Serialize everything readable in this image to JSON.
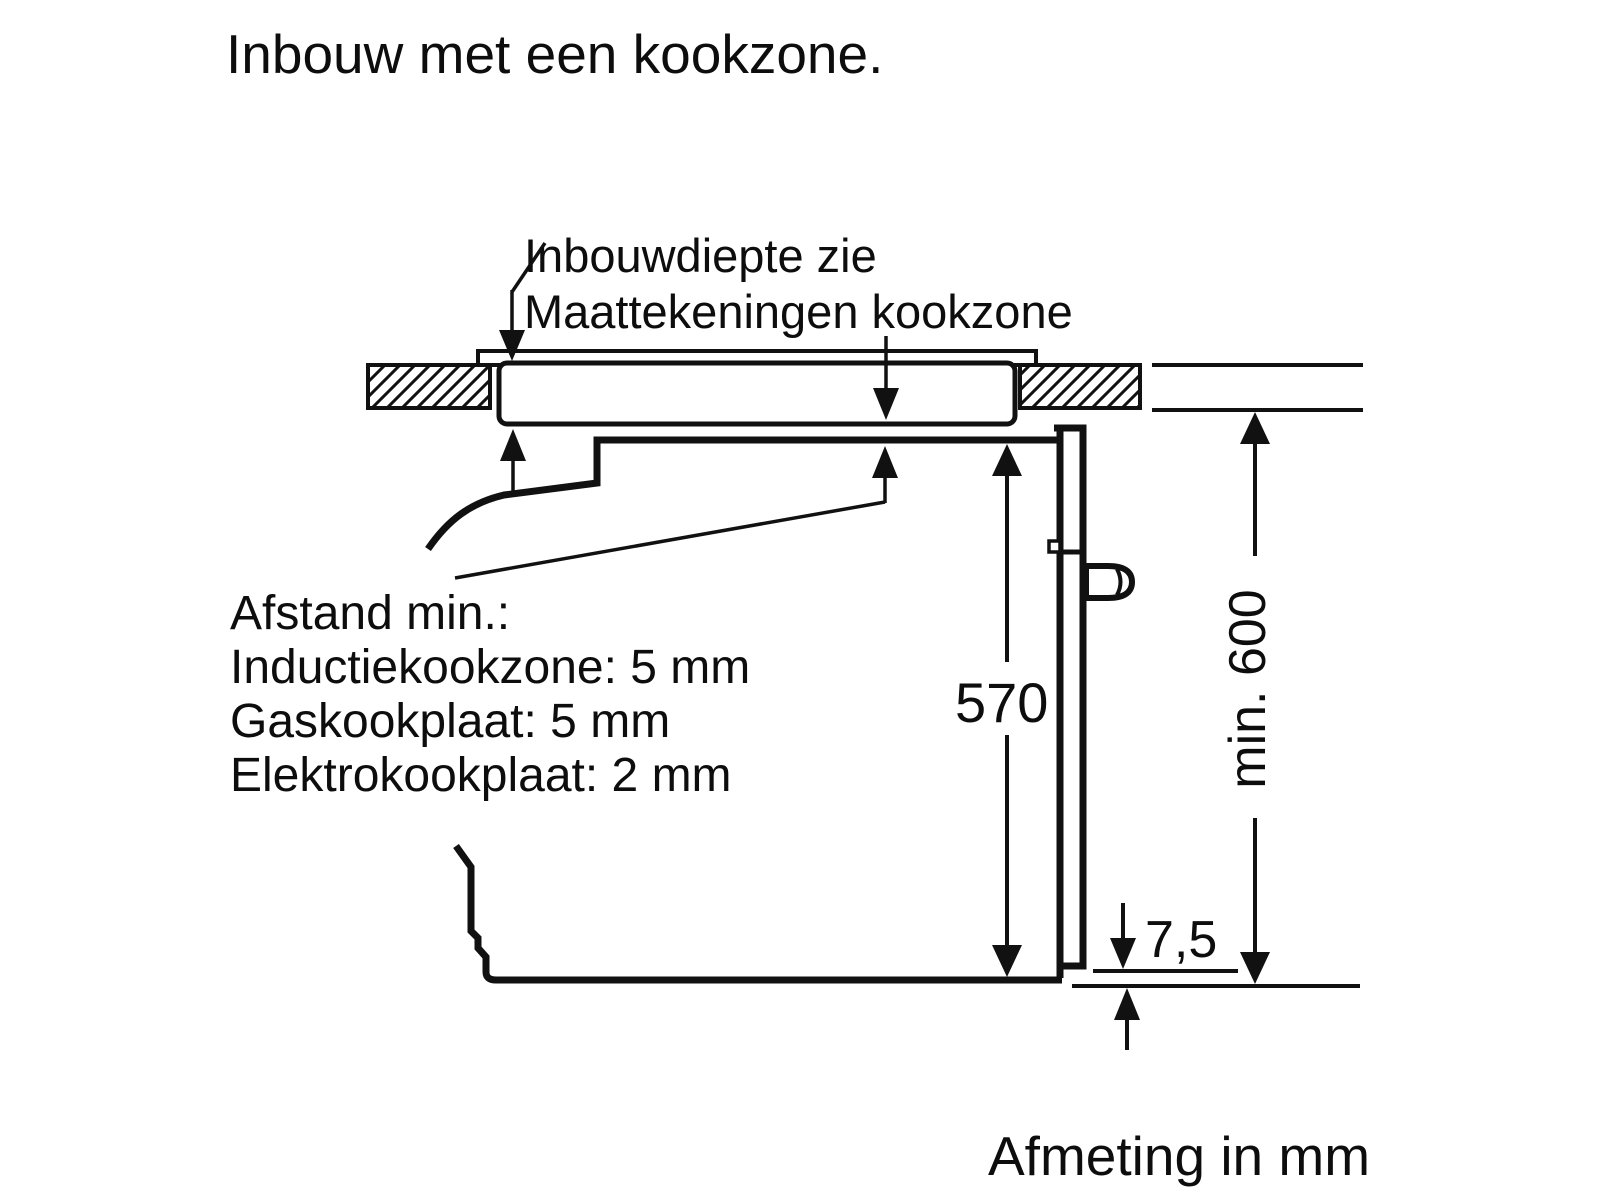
{
  "title": "Inbouw met een kookzone.",
  "callout_hob": {
    "line1": "Inbouwdiepte zie",
    "line2": "Maattekeningen kookzone"
  },
  "callout_clearance": {
    "heading": "Afstand min.:",
    "induction": "Inductiekookzone: 5 mm",
    "gas": "Gaskookplaat: 5 mm",
    "electric": "Elektrokookplaat: 2 mm"
  },
  "dimensions": {
    "oven_height_mm": "570",
    "bottom_gap_mm": "7,5",
    "niche_min_height": "min. 600"
  },
  "footer_note": "Afmeting in mm",
  "colors": {
    "ink": "#111111",
    "background": "#ffffff"
  }
}
